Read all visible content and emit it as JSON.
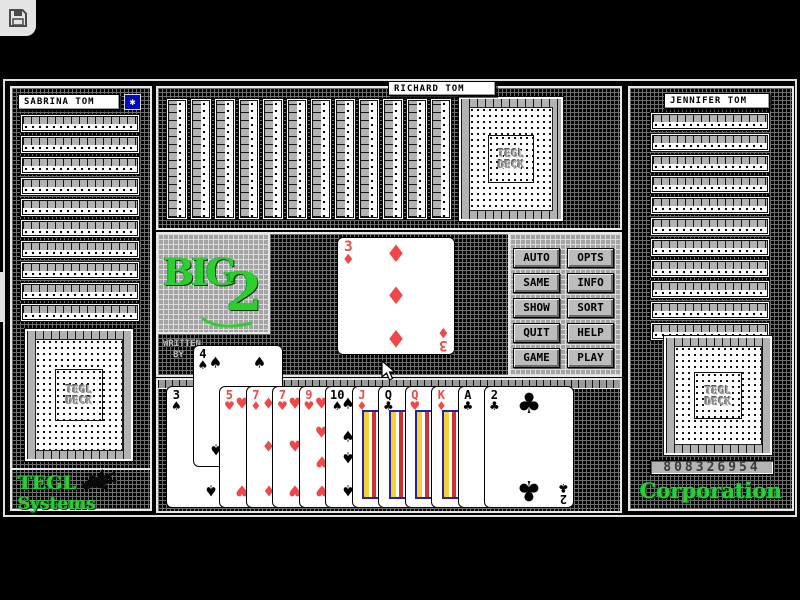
{
  "chrome": {
    "save_icon": "floppy-disk",
    "side_tab_chevron": ">"
  },
  "players": {
    "left": {
      "name": "SABRINA TOM",
      "visible_card_edges": 10,
      "turn_badge_star": "✱"
    },
    "top": {
      "name": "RICHARD TOM",
      "visible_card_edges": 12
    },
    "right": {
      "name": "JENNIFER TOM",
      "visible_card_edges": 11,
      "serial_number": "808326954"
    },
    "bottom": {
      "hand": [
        {
          "rank": "3",
          "suit": "spade"
        },
        {
          "rank": "4",
          "suit": "spade",
          "raised": true
        },
        {
          "rank": "5",
          "suit": "heart"
        },
        {
          "rank": "7",
          "suit": "diamond"
        },
        {
          "rank": "7",
          "suit": "heart"
        },
        {
          "rank": "9",
          "suit": "heart"
        },
        {
          "rank": "10",
          "suit": "spade"
        },
        {
          "rank": "J",
          "suit": "diamond"
        },
        {
          "rank": "Q",
          "suit": "club"
        },
        {
          "rank": "Q",
          "suit": "heart"
        },
        {
          "rank": "K",
          "suit": "diamond"
        },
        {
          "rank": "A",
          "suit": "club"
        },
        {
          "rank": "2",
          "suit": "club"
        }
      ]
    }
  },
  "table": {
    "played_card": {
      "rank": "3",
      "suit": "diamond"
    }
  },
  "deck_back": {
    "line1": "TEGL",
    "line2": "DECK"
  },
  "logo": {
    "word": "BIG",
    "number": "2"
  },
  "credits": {
    "line1": "WRITTEN",
    "line2": "BY"
  },
  "buttons": [
    "AUTO",
    "OPTS",
    "SAME",
    "INFO",
    "SHOW",
    "SORT",
    "QUIT",
    "HELP",
    "GAME",
    "PLAY"
  ],
  "branding": {
    "bottom_left_line1": "TEGL",
    "bottom_left_line2": "Systems",
    "bottom_right": "Corporation"
  },
  "suit_glyphs": {
    "spade": "♠",
    "heart": "♥",
    "diamond": "♦",
    "club": "♣"
  },
  "colors": {
    "red_suit": "#f04848",
    "black_suit": "#000000",
    "green_brand": "#2ece2e",
    "badge_blue": "#0008c0"
  }
}
